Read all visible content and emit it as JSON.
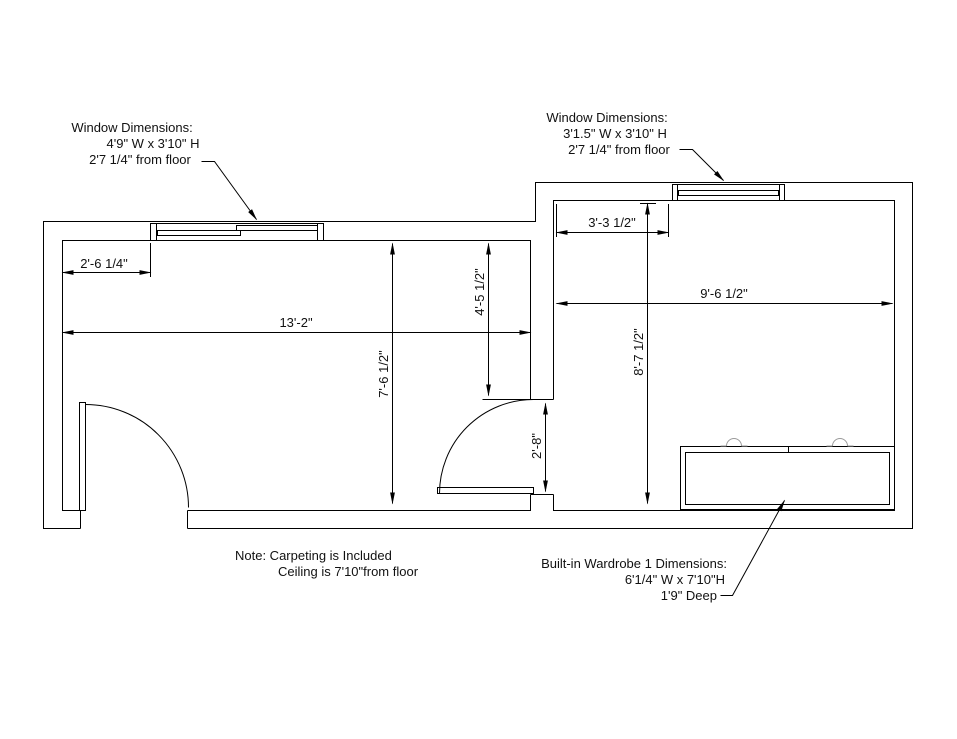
{
  "annotations": {
    "window1": {
      "l1": "Window Dimensions:",
      "l2": "4'9\" W x 3'10\" H",
      "l3": "2'7 1/4\" from floor"
    },
    "window2": {
      "l1": "Window Dimensions:",
      "l2": "3'1.5\" W x 3'10\" H",
      "l3": "2'7 1/4\" from floor"
    },
    "wardrobe": {
      "l1": "Built-in Wardrobe 1 Dimensions:",
      "l2": "6'1/4\" W x 7'10\"H",
      "l3": "1'9\" Deep"
    },
    "note": {
      "l1": "Note: Carpeting is Included",
      "l2": "Ceiling is 7'10\"from floor"
    }
  },
  "dimensions": {
    "wall_to_window_left": "2'-6 1/4\"",
    "left_room_width": "13'-2\"",
    "left_room_depth": "7'-6 1/2\"",
    "partition_wall_upper": "4'-5 1/2\"",
    "door_opening": "2'-8\"",
    "wall_to_window_right": "3'-3 1/2\"",
    "right_room_width": "9'-6 1/2\"",
    "right_room_depth": "8'-7 1/2\""
  },
  "colors": {
    "line": "#000000",
    "handle": "#9a9a9a",
    "background": "#ffffff"
  }
}
